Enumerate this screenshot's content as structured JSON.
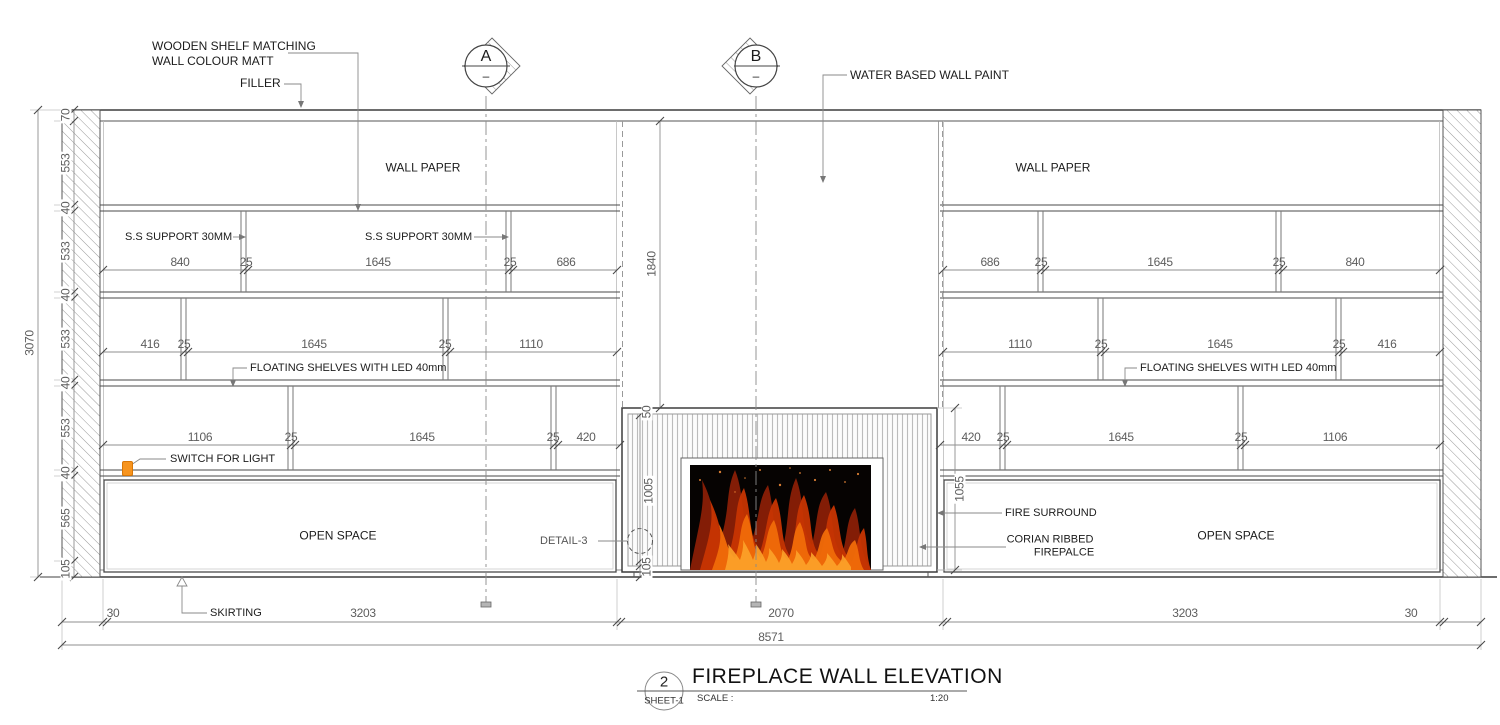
{
  "labels": {
    "wooden_shelf_line1": "WOODEN SHELF MATCHING",
    "wooden_shelf_line2": "WALL COLOUR MATT",
    "filler": "FILLER",
    "water_paint": "WATER BASED WALL PAINT",
    "wall_paper_left": "WALL PAPER",
    "wall_paper_right": "WALL PAPER",
    "ss_support_left": "S.S SUPPORT 30MM",
    "ss_support_mid": "S.S SUPPORT 30MM",
    "floating_left": "FLOATING SHELVES WITH LED 40mm",
    "floating_right": "FLOATING SHELVES WITH LED 40mm",
    "switch": "SWITCH FOR LIGHT",
    "open_left": "OPEN SPACE",
    "open_right": "OPEN SPACE",
    "detail3": "DETAIL-3",
    "fire_surround": "FIRE SURROUND",
    "corian_line1": "CORIAN RIBBED",
    "corian_line2": "FIREPALCE",
    "skirting": "SKIRTING"
  },
  "markers": {
    "a": {
      "letter": "A",
      "sub": "–"
    },
    "b": {
      "letter": "B",
      "sub": "–"
    }
  },
  "dims": {
    "left_chain": [
      "70",
      "553",
      "40",
      "533",
      "40",
      "533",
      "40",
      "553",
      "40",
      "565",
      "105"
    ],
    "left_total": "3070",
    "row1_left": [
      "840",
      "25",
      "1645",
      "25",
      "686"
    ],
    "row2_left": [
      "416",
      "25",
      "1645",
      "25",
      "1110"
    ],
    "row3_left": [
      "1106",
      "25",
      "1645",
      "25",
      "420"
    ],
    "row1_right": [
      "686",
      "25",
      "1645",
      "25",
      "840"
    ],
    "row2_right": [
      "1110",
      "25",
      "1645",
      "25",
      "416"
    ],
    "row3_right": [
      "420",
      "25",
      "1645",
      "25",
      "1106"
    ],
    "chimney_height": "1840",
    "surround_top": "50",
    "opening_height": "1005",
    "base_height": "105",
    "surround_height": "1055",
    "bottom_row": [
      "30",
      "3203",
      "2070",
      "3203",
      "30"
    ],
    "bottom_total": "8571"
  },
  "titleblock": {
    "number": "2",
    "sheet": "SHEET-1",
    "title": "FIREPLACE WALL ELEVATION",
    "scale_label": "SCALE :",
    "scale_value": "1:20"
  },
  "colors": {
    "switch_orange": "#F7941E",
    "line_dark": "#3d3d3d",
    "dim_gray": "#5d5d5d",
    "flame_orange": "#e2590a"
  }
}
